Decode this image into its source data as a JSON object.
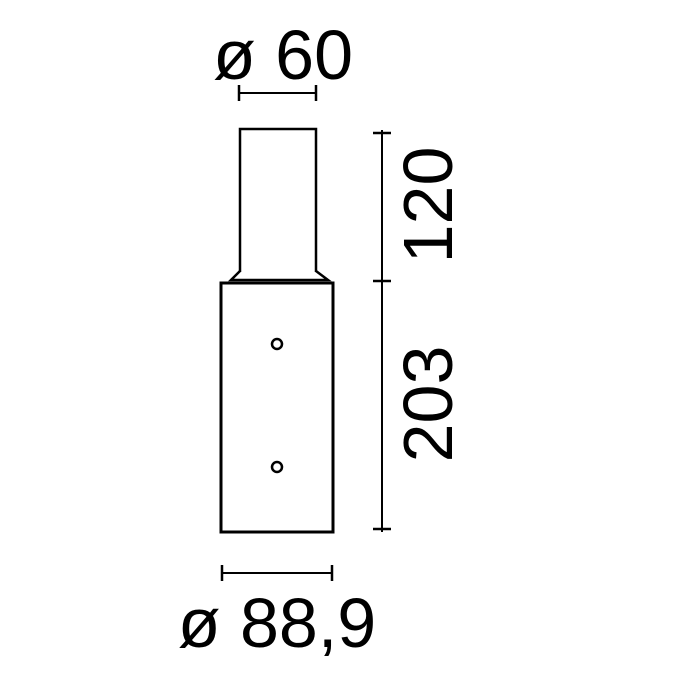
{
  "figure": {
    "type": "technical-dimension-drawing",
    "background_color": "#ffffff",
    "line_color": "#000000",
    "labels": {
      "top_diameter": "ø 60",
      "upper_height": "120",
      "lower_height": "203",
      "bottom_diameter": "ø 88,9"
    },
    "values": {
      "top_diameter_mm": 60,
      "upper_height_mm": 120,
      "lower_height_mm": 203,
      "bottom_diameter_mm": 88.9,
      "hole_count": 2
    }
  }
}
